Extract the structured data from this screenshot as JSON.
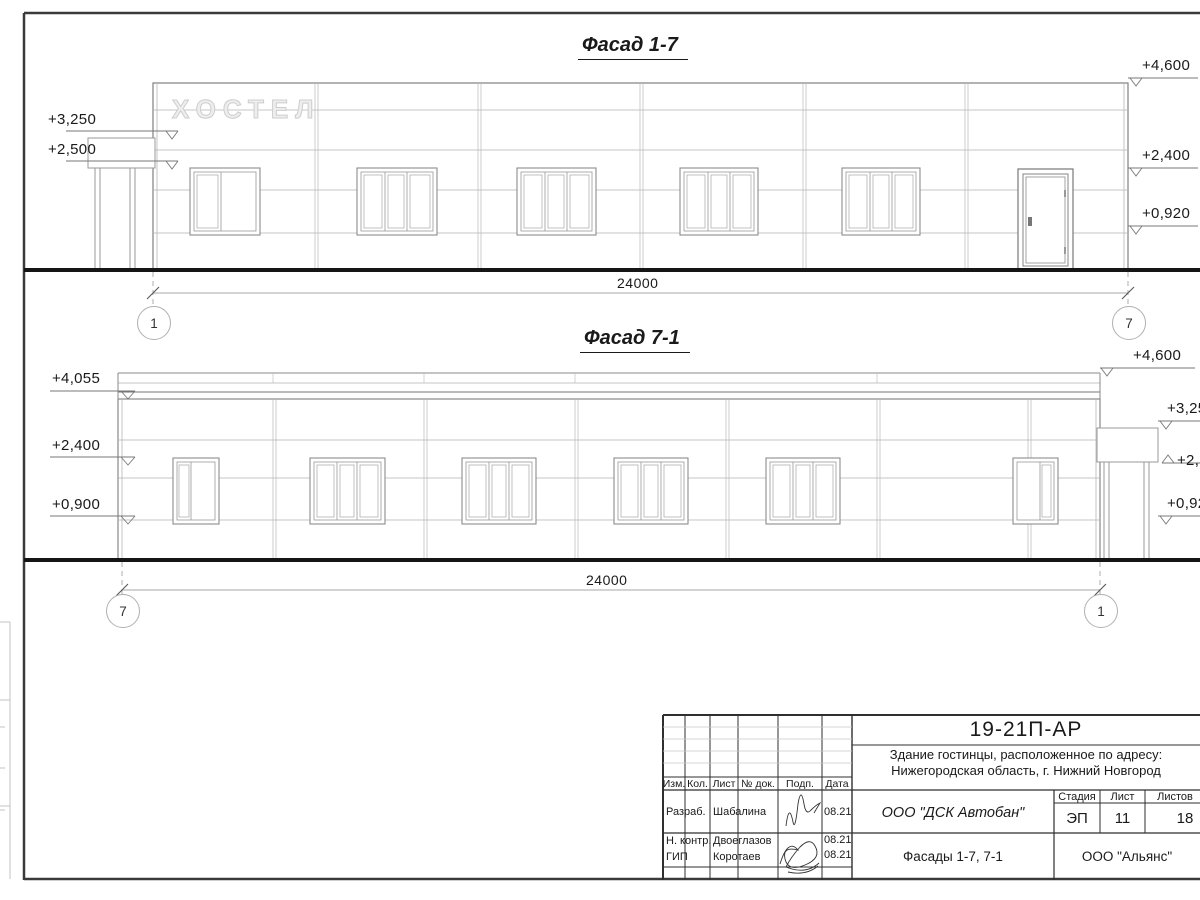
{
  "facade1": {
    "title": "Фасад 1-7",
    "sign_text": "ХОСТЕЛ",
    "marks_left": [
      "+3,250",
      "+2,500"
    ],
    "marks_right": [
      "+4,600",
      "+2,400",
      "+0,920"
    ],
    "dimension": "24000",
    "axis_left": "1",
    "axis_right": "7"
  },
  "facade2": {
    "title": "Фасад 7-1",
    "marks_left": [
      "+4,055",
      "+2,400",
      "+0,900"
    ],
    "marks_right": [
      "+4,600",
      "+3,250",
      "+2,500",
      "+0,920"
    ],
    "dimension": "24000",
    "axis_left": "7",
    "axis_right": "1"
  },
  "stamp": {
    "doc_number": "19-21П-АР",
    "project_line1": "Здание гостинцы, расположенное по адресу:",
    "project_line2": "Нижегородская область, г. Нижний Новгород",
    "columns": {
      "izm": "Изм.",
      "kol": "Кол.",
      "list": "Лист",
      "doc": "№ док.",
      "podp": "Подп.",
      "data": "Дата"
    },
    "rows": [
      {
        "role": "Разраб.",
        "name": "Шабалина",
        "date": "08.21"
      },
      {
        "role": "Н. контр.",
        "name": "Двоеглазов",
        "date": "08.21"
      },
      {
        "role": "ГИП",
        "name": "Коротаев",
        "date": "08.21"
      }
    ],
    "company": "ООО \"ДСК Автобан\"",
    "stage_label": "Стадия",
    "sheet_label": "Лист",
    "sheets_label": "Листов",
    "stage": "ЭП",
    "sheet_no": "11",
    "sheets_total": "18",
    "sheet_title": "Фасады 1-7, 7-1",
    "contractor": "ООО \"Альянс\""
  }
}
